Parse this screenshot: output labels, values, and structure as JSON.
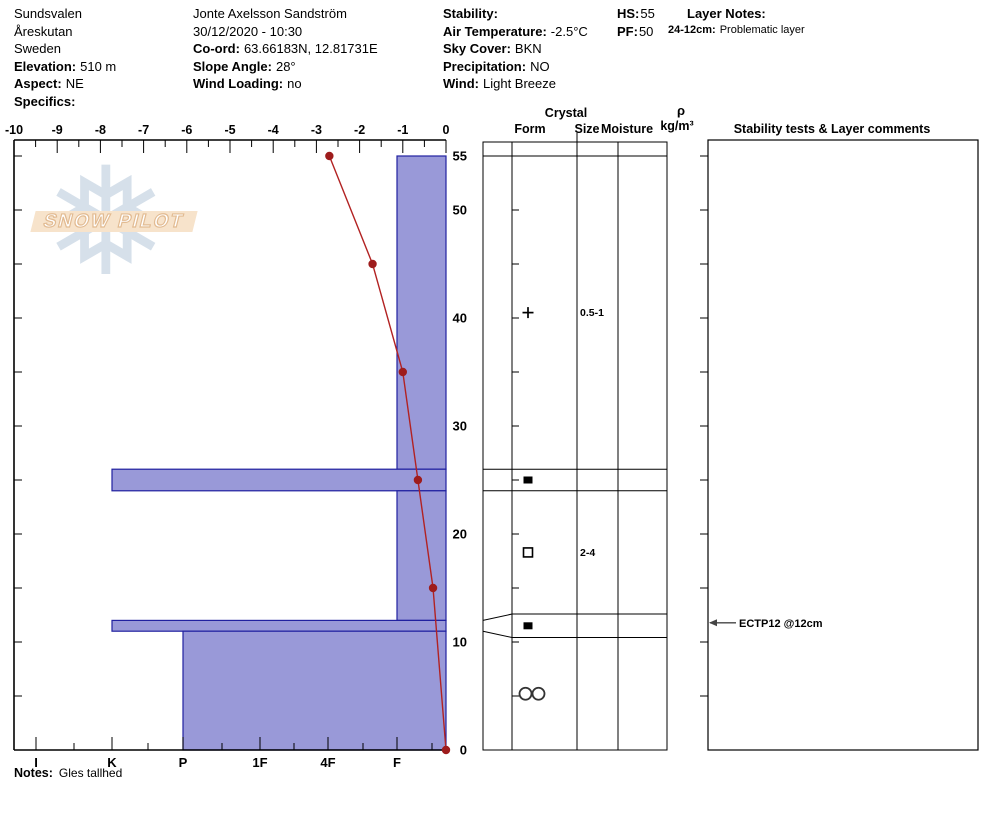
{
  "header": {
    "columns": [
      {
        "lines": [
          {
            "l": "",
            "v": "Sundsvalen"
          },
          {
            "l": "",
            "v": "Åreskutan"
          },
          {
            "l": "",
            "v": "Sweden"
          },
          {
            "l": "Elevation:",
            "v": "510 m"
          },
          {
            "l": "Aspect:",
            "v": "NE"
          },
          {
            "l": "Specifics:",
            "v": ""
          }
        ]
      },
      {
        "lines": [
          {
            "l": "",
            "v": "Jonte Axelsson Sandström"
          },
          {
            "l": "",
            "v": "30/12/2020 - 10:30"
          },
          {
            "l": "Co-ord:",
            "v": "63.66183N, 12.81731E"
          },
          {
            "l": "Slope Angle:",
            "v": "28°"
          },
          {
            "l": "Wind Loading:",
            "v": "no"
          }
        ]
      },
      {
        "lines": [
          {
            "l": "Stability:",
            "v": ""
          },
          {
            "l": "Air Temperature:",
            "v": "-2.5°C"
          },
          {
            "l": "Sky Cover:",
            "v": "BKN"
          },
          {
            "l": "Precipitation:",
            "v": "NO"
          },
          {
            "l": "Wind:",
            "v": "Light Breeze"
          }
        ]
      },
      {
        "lines": [
          {
            "l": "HS:",
            "v": "55"
          },
          {
            "l": "PF:",
            "v": "50"
          }
        ]
      },
      {
        "lines": [
          {
            "l": "Layer Notes:",
            "v": ""
          },
          {
            "l": "24-12cm:",
            "v": "Problematic layer",
            "small": true
          }
        ]
      }
    ]
  },
  "table_headers": {
    "crystal": "Crystal",
    "form": "Form",
    "size": "Size",
    "moisture": "Moisture",
    "rho": "ρ",
    "rho_unit": "kg/m³",
    "stability": "Stability tests & Layer comments"
  },
  "notes": {
    "label": "Notes:",
    "value": "Gles tallhed"
  },
  "logo": {
    "text": "SNOW PILOT",
    "flake_icon": "snowflake-icon"
  },
  "chart_data": {
    "type": "snow-profile",
    "temp_axis": {
      "unit": "°C",
      "min": -10,
      "max": 0,
      "major_step": 1,
      "minor_step": 0.5,
      "labels": [
        "-10",
        "-9",
        "-8",
        "-7",
        "-6",
        "-5",
        "-4",
        "-3",
        "-2",
        "-1",
        "0"
      ]
    },
    "height_axis": {
      "unit": "cm",
      "min": 0,
      "max": 56.5,
      "tick_step": 5,
      "labels": [
        55,
        50,
        40,
        30,
        20,
        10,
        0
      ]
    },
    "hardness_axis": {
      "labels": [
        "I",
        "K",
        "P",
        "1F",
        "4F",
        "F"
      ]
    },
    "temperature_profile": [
      {
        "height_cm": 55,
        "temp_c": -2.7
      },
      {
        "height_cm": 45,
        "temp_c": -1.7
      },
      {
        "height_cm": 35,
        "temp_c": -1.0
      },
      {
        "height_cm": 25,
        "temp_c": -0.65
      },
      {
        "height_cm": 15,
        "temp_c": -0.3
      },
      {
        "height_cm": 0,
        "temp_c": 0.0
      }
    ],
    "layers": [
      {
        "top_cm": 55,
        "bottom_cm": 26,
        "hardness": "F",
        "grain_form_glyph": "+",
        "grain_size_mm": "0.5-1"
      },
      {
        "top_cm": 26,
        "bottom_cm": 24,
        "hardness": "K",
        "grain_form_glyph": "■",
        "grain_size_mm": ""
      },
      {
        "top_cm": 24,
        "bottom_cm": 12,
        "hardness": "F",
        "grain_form_glyph": "□",
        "grain_size_mm": "2-4"
      },
      {
        "top_cm": 12,
        "bottom_cm": 11,
        "hardness": "K",
        "grain_form_glyph": "■",
        "grain_size_mm": ""
      },
      {
        "top_cm": 11,
        "bottom_cm": 0,
        "hardness": "P",
        "grain_form_glyph": "○○",
        "grain_size_mm": ""
      }
    ],
    "annotations": [
      {
        "text": "ECTP12 @12cm",
        "layer_top_cm": 12
      }
    ],
    "colors": {
      "bar_fill": "#9999d8",
      "bar_border": "#2121a0",
      "temp_line": "#b22222",
      "temp_dot": "#9e1c1c",
      "grid": "#000000",
      "logo_banner": "#f7e3cb",
      "logo_flake": "#cfdbe7"
    }
  }
}
